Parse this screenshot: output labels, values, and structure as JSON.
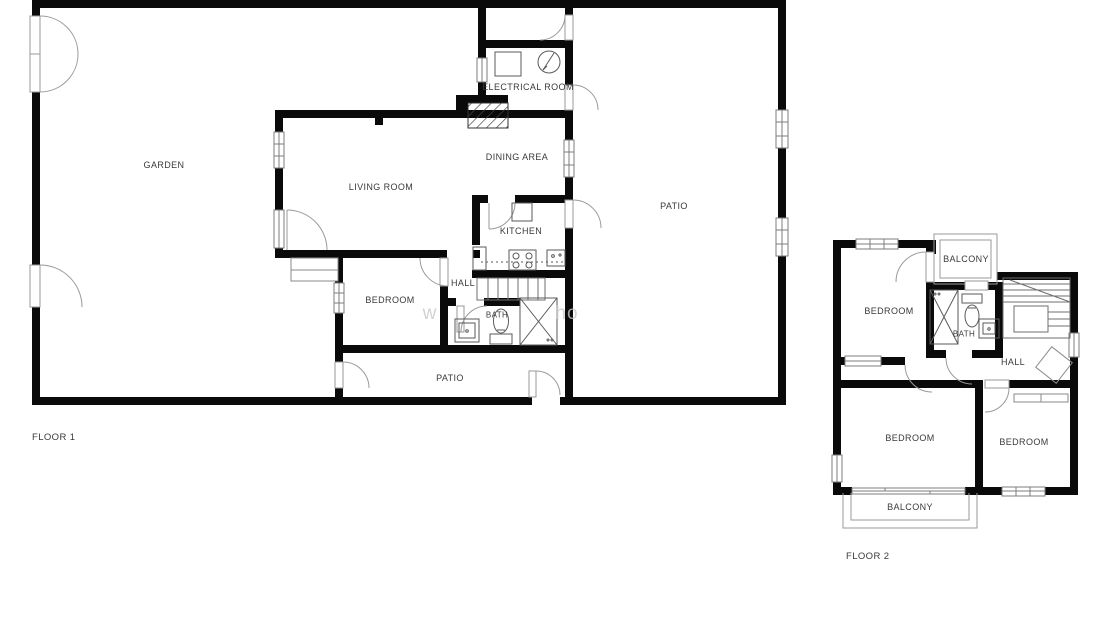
{
  "document": {
    "type": "architectural floor plan",
    "sheets": [
      "FLOOR 1",
      "FLOOR 2"
    ]
  },
  "floor1": {
    "label": "FLOOR 1",
    "rooms": {
      "garden": "GARDEN",
      "living_room": "LIVING ROOM",
      "dining_area": "DINING AREA",
      "electrical_room": "ELECTRICAL ROOM",
      "kitchen": "KITCHEN",
      "patio_right": "PATIO",
      "bedroom": "BEDROOM",
      "hall": "HALL",
      "bath": "BATH",
      "patio_bottom": "PATIO"
    }
  },
  "floor2": {
    "label": "FLOOR 2",
    "rooms": {
      "balcony_top": "BALCONY",
      "bedroom_top": "BEDROOM",
      "bath": "BATH",
      "hall": "HALL",
      "bedroom_left": "BEDROOM",
      "bedroom_right": "BEDROOM",
      "balcony_bottom": "BALCONY"
    }
  },
  "watermark": {
    "fragment1": "w",
    "fragment2": "ho"
  },
  "colors": {
    "wall": "#0a0a0a",
    "label": "#3a3a3a",
    "door_arc": "#9a9a9a",
    "fixture": "#5a5a5a",
    "background": "#ffffff"
  }
}
